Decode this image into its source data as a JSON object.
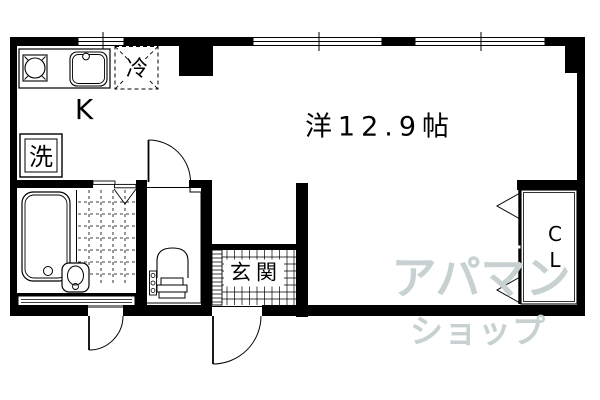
{
  "colors": {
    "background": "#ffffff",
    "line": "#000000",
    "watermark": "#c7d1d1"
  },
  "rooms": {
    "kitchen": {
      "label": "K"
    },
    "western_room": {
      "label": "洋12.9帖"
    },
    "entrance": {
      "label": "玄関"
    },
    "closet": {
      "label_lines": [
        "C",
        "L"
      ]
    }
  },
  "appliances": {
    "refrigerator": {
      "label": "冷"
    },
    "washing_machine": {
      "label": "洗"
    }
  },
  "watermark": {
    "line1": "アパマン",
    "line2": "ショップ"
  },
  "icons": {
    "stove": "burner-circle-in-square",
    "kitchen_sink": "double-rounded-basin-with-faucet-dot",
    "refrigerator": "dashed-box-with-x",
    "washing_machine_pan": "nested-squares",
    "bathtub": "nested-rounded-tub-with-drain-dot",
    "shower_floor": "dashed-tile-grid",
    "vanity_basin": "rounded-box-with-oval",
    "toilet": "arched-bowl-with-tank-and-buttons",
    "entrance_floor": "tile-grid",
    "shoe_cabinet": "slatted-strip",
    "swing_door": "quarter-arc-with-leaf",
    "bifold_closet_door": "chevron-pair",
    "window": "triple-line-band-with-tick",
    "louver_window": "slotted-band"
  }
}
